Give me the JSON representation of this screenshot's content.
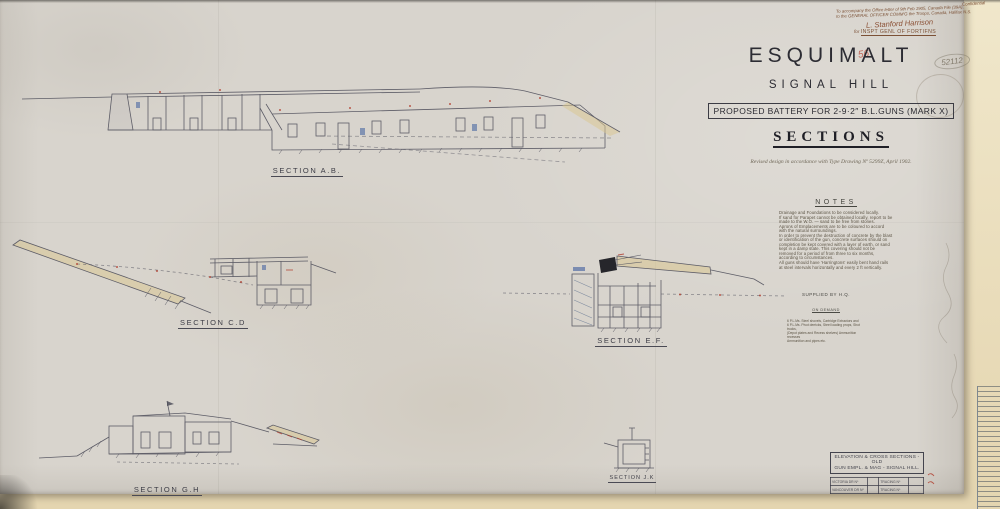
{
  "annotations": {
    "corner_note": "Confidential",
    "office_note_line1": "To accompany the Office letter of 9th Feb 1905, Canada File (39A),",
    "office_note_line2": "to the GENERAL OFFICER COMM'G the Troops, Canada, Halifax N.S.",
    "signature": "L. Stanford Harrison",
    "signature_prefix": "for",
    "signature_title": "INSPT GENL OF FORTIFNS",
    "red_number": "56",
    "pencil_number": "52112"
  },
  "title_block": {
    "title": "ESQUIMALT",
    "subtitle": "SIGNAL HILL",
    "proposal": "PROPOSED BATTERY FOR 2-9·2″ B.L.GUNS (MARK X)",
    "drawing_type": "SECTIONS",
    "revision_note": "Revised design in accordance with Type Drawing Nº 5299Z, April 1902."
  },
  "notes": {
    "heading": "NOTES",
    "lines": [
      "Drainage and Foundations to be considered locally.",
      "If sand for Parapet cannot be obtained locally, report to be",
      "made to the W.O. — sand to be free from stones.",
      "Aprons of Emplacements are to be coloured to accord",
      "with the natural surroundings.",
      "In order to prevent the destruction of concrete by the blast",
      "or identification of the gun, concrete surfaces should on",
      "completion be kept covered with a layer of earth, or sand",
      "kept in a damp state.  This covering should not be",
      "removed for a period of from three to six months,",
      "according to circumstances.",
      "All guns should have 'Harringtons' easily bent hand rails",
      "at steel intervals horizontally and every 2 ft vertically."
    ]
  },
  "supply_note": {
    "heading": "SUPPLIED BY H.Q.",
    "subheading": "ON DEMAND",
    "lines": [
      "6 P.L.Ms. Steel shovels, Cartridge Extractors and",
      "6 P.L.Ms. Pivot derricks, Steel loading props, Shot trucks,",
      "(Depot plates and Recess shelves) Ammunition recesses",
      "Ammunition and pipes etc."
    ]
  },
  "sections": [
    {
      "label": "SECTION  A.B."
    },
    {
      "label": "SECTION  C.D"
    },
    {
      "label": "SECTION  E.F."
    },
    {
      "label": "SECTION  G.H"
    },
    {
      "label": "SECTION  J.K"
    }
  ],
  "footer_block": {
    "line1": "ELEVATION & CROSS SECTIONS - OLD",
    "line2": "GUN EMPL. & MAG - SIGNAL HILL.",
    "table": {
      "rows": [
        [
          "VICTORIA  DR Nº",
          "",
          "TRACING Nº",
          ""
        ],
        [
          "VANCOUVER  DR Nº",
          "",
          "TRACING Nº",
          ""
        ]
      ]
    }
  },
  "colors": {
    "paper": "#d8d4cd",
    "backing": "#ead9b5",
    "ink": "#50505c",
    "sepia_ink": "#7c5136",
    "red_accent": "#b03a2a",
    "blue_accent": "#3d5c9e",
    "earth_tan": "#d8c48d",
    "ruler": "#b3bac0"
  }
}
